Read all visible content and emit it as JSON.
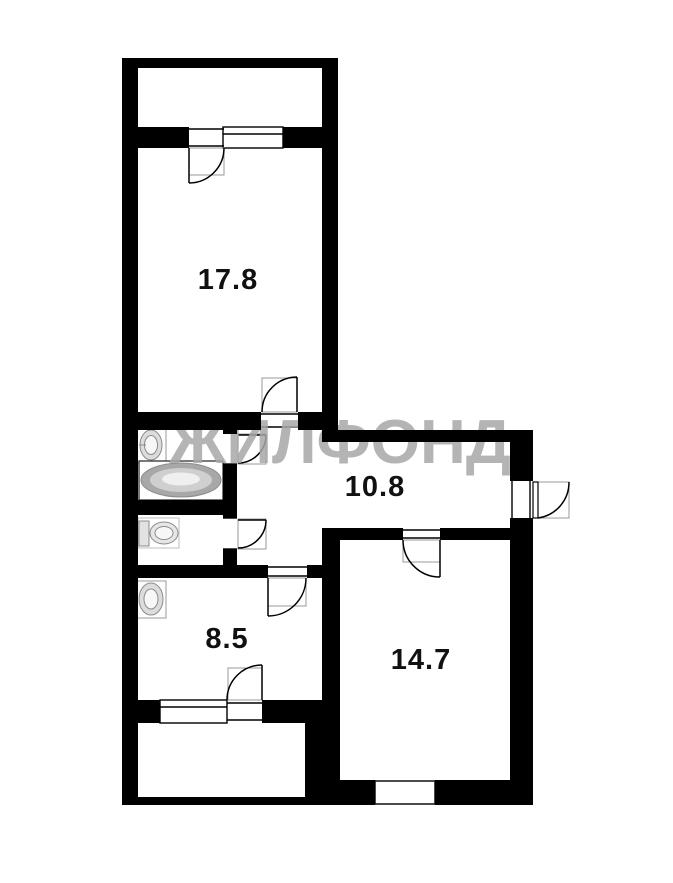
{
  "plan": {
    "watermark_text": "ЖИЛФОНД",
    "rooms": [
      {
        "name": "living-room",
        "area": "17.8"
      },
      {
        "name": "hallway",
        "area": "10.8"
      },
      {
        "name": "kitchen",
        "area": "8.5"
      },
      {
        "name": "bedroom",
        "area": "14.7"
      }
    ],
    "fixtures": [
      {
        "icon": "bathroom-sink-icon"
      },
      {
        "icon": "bathtub-icon"
      },
      {
        "icon": "toilet-icon"
      },
      {
        "icon": "kitchen-sink-icon"
      }
    ],
    "colors": {
      "wall": "#000000",
      "background": "#ffffff",
      "watermark": "#a8a8a8",
      "room_label": "#111111",
      "fixture_stroke": "#8c8c8c",
      "door_frame": "#9a9a9a",
      "door_line": "#000000"
    }
  }
}
